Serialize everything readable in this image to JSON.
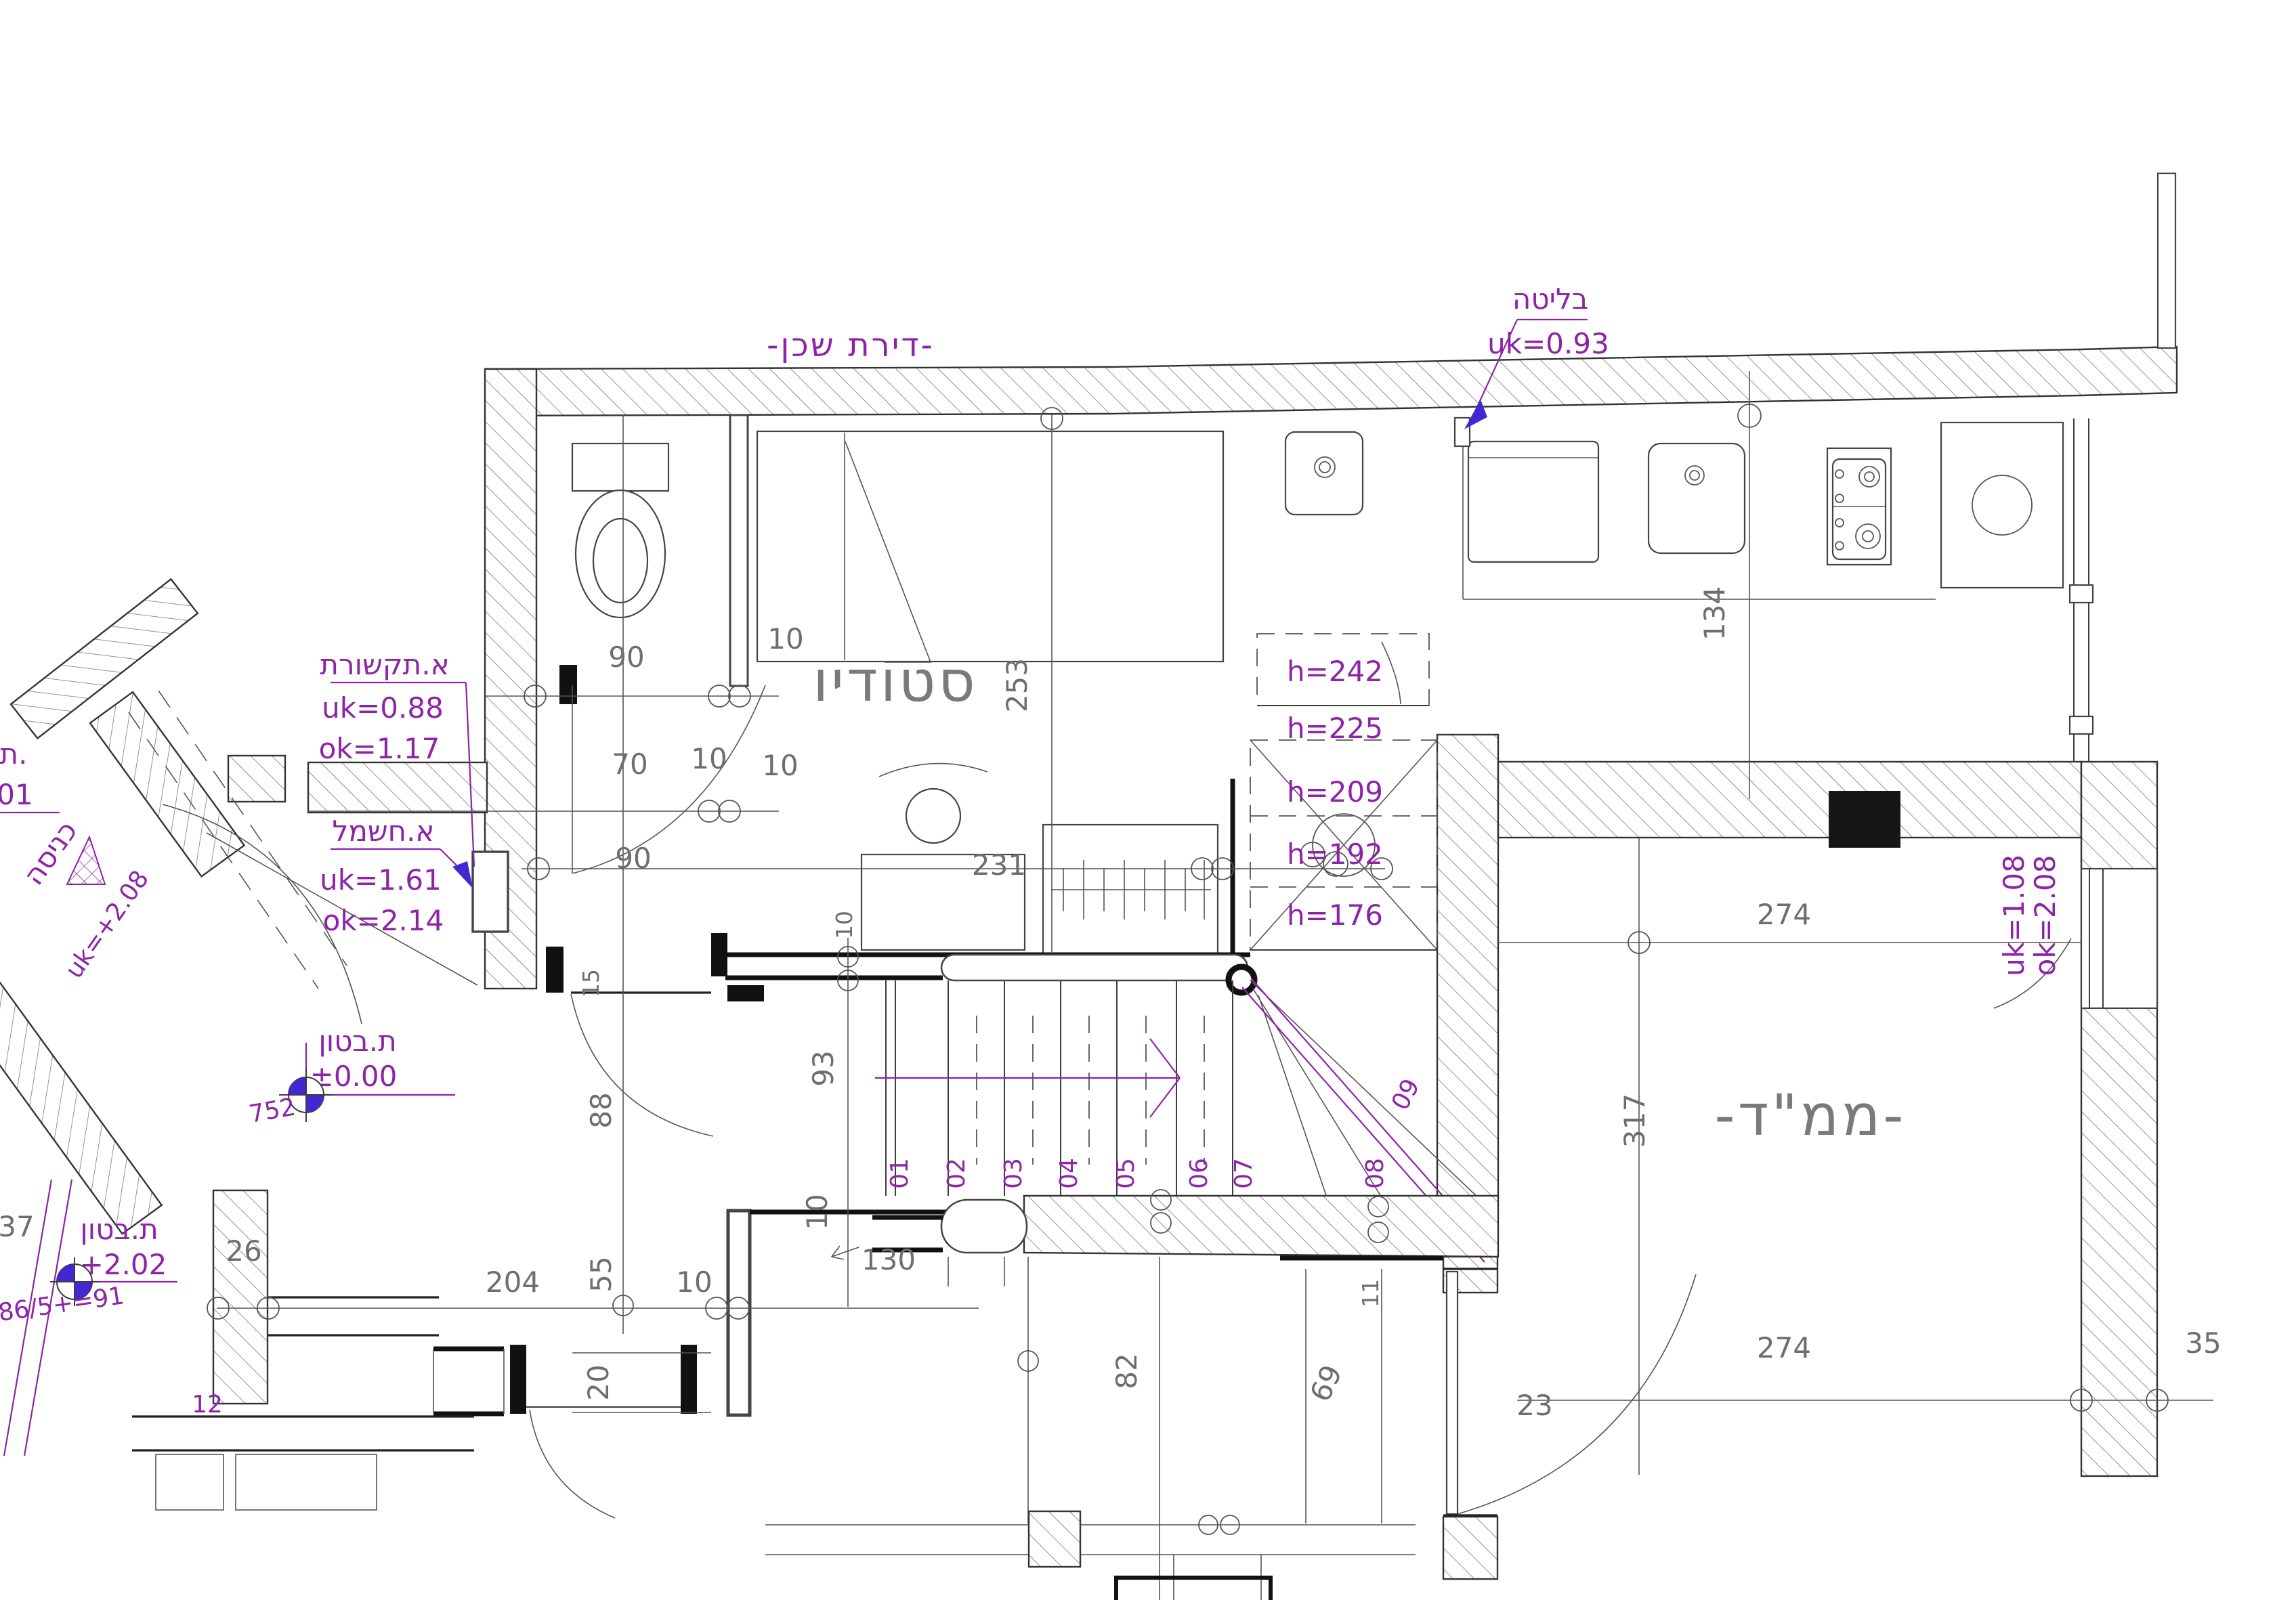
{
  "title": "-דירת שכן-",
  "rooms": {
    "studio": "סטודיו",
    "mamad": "-ממ\"ד-"
  },
  "colors": {
    "annotation": "#8d23a8",
    "marker": "#4527d2",
    "dimension": "#6e6e6e"
  },
  "annotations": {
    "bulge_label": "בליטה",
    "bulge_uk": "uk=0.93",
    "comm_label": "א.תקשורת",
    "comm_uk": "uk=0.88",
    "comm_ok": "ok=1.17",
    "elec_label": "א.חשמל",
    "elec_uk": "uk=1.61",
    "elec_ok": "ok=2.14",
    "concrete_label_1": "ת.בטון",
    "concrete_value_1": "±0.00",
    "concrete_note_1": "752",
    "concrete_label_2": "ת.בטון",
    "concrete_value_2": "+2.02",
    "concrete_note_2": "86/5+=91",
    "entry_label": "כניסה",
    "entry_uk": "uk=+2.08",
    "window_uk": "uk=1.08",
    "window_ok": "ok=2.08",
    "edge_t": "ת.",
    "edge_01": "01",
    "num_12": "12"
  },
  "heights": [
    "h=242",
    "h=225",
    "h=209",
    "h=192",
    "h=176"
  ],
  "stairs": [
    "01",
    "02",
    "03",
    "04",
    "05",
    "06",
    "07",
    "08",
    "09"
  ],
  "dims": {
    "bath_w": "90",
    "bath_d": "70",
    "t10_a": "10",
    "t10_b": "10",
    "t10_bed": "10",
    "bed_len": "253",
    "kitchen_d": "134",
    "desk_len": "231",
    "door_w": "90",
    "jamb_15": "15",
    "hall_88": "88",
    "stair_93": "93",
    "t10_desk": "10",
    "t10_stair": "10",
    "row_204": "204",
    "row_55": "55",
    "row_20": "20",
    "row_10": "10",
    "row_130": "130",
    "wall_26": "26",
    "num_37": "37",
    "col_82": "82",
    "col_69": "69",
    "col_11": "11",
    "col_23": "23",
    "mamad_top": "274",
    "mamad_bot": "274",
    "mamad_317": "317",
    "wall_35": "35"
  }
}
